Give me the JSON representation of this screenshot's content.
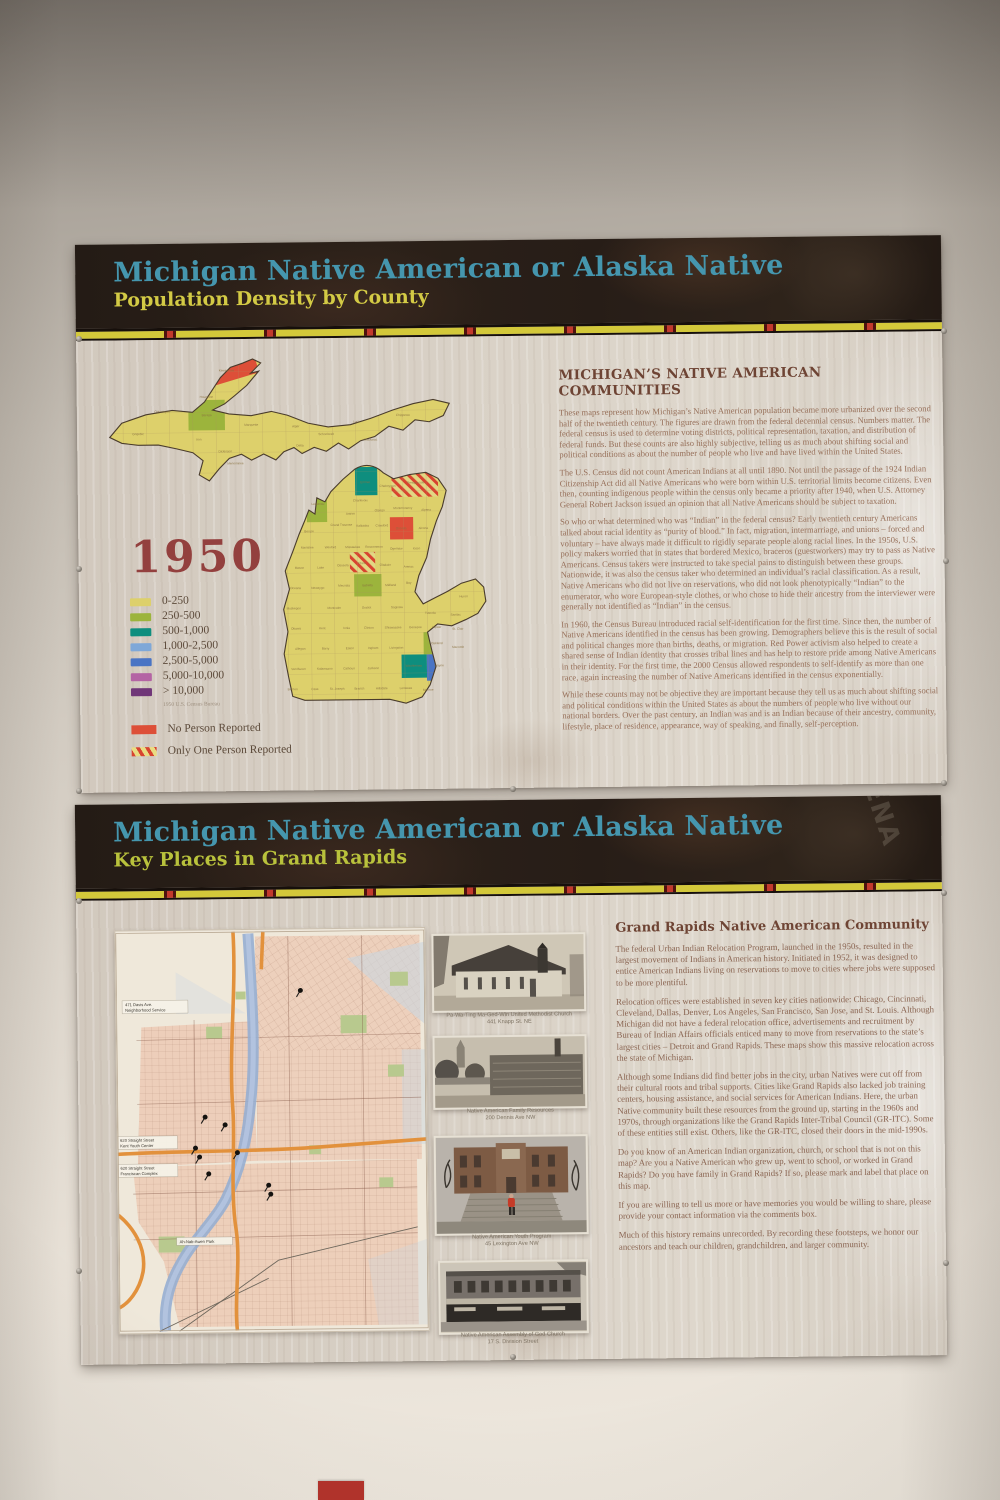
{
  "poster_population": {
    "title": "Michigan Native American or Alaska Native",
    "subtitle": "Population Density by County",
    "year": "1950",
    "source_note": "1950 U.S. Census Bureau",
    "section_heading": "MICHIGAN’S NATIVE AMERICAN COMMUNITIES",
    "paragraphs": [
      "These maps represent how Michigan’s Native American population became more urbanized over the second half of the twentieth century. The figures are drawn from the federal decennial census. Numbers matter. The federal census is used to determine voting districts, political representation, taxation, and distribution of federal funds. But these counts are also highly subjective, telling us as much about shifting social and political conditions as about the number of people who live and have lived within the United States.",
      "The U.S. Census did not count American Indians at all until 1890. Not until the passage of the 1924 Indian Citizenship Act did all Native Americans who were born within U.S. territorial limits become citizens. Even then, counting indigenous people within the census only became a priority after 1940, when U.S. Attorney General Robert Jackson issued an opinion that all Native Americans should be subject to taxation.",
      "So who or what determined who was “Indian” in the federal census? Early twentieth century Americans talked about racial identity as “purity of blood.” In fact, migration, intermarriage, and unions – forced and voluntary – have always made it difficult to rigidly separate people along racial lines. In the 1950s, U.S. policy makers worried that in states that bordered Mexico, braceros (guestworkers) may try to pass as Native Americans. Census takers were instructed to take special pains to distinguish between these groups. Nationwide, it was also the census taker who determined an individual’s racial classification. As a result, Native Americans who did not live on reservations, who did not look phenotypically “Indian” to the enumerator, who wore European-style clothes, or who chose to hide their ancestry from the interviewer were generally not identified as “Indian” in the census.",
      "In 1960, the Census Bureau introduced racial self-identification for the first time. Since then, the number of Native Americans identified in the census has been growing. Demographers believe this is the result of social and political changes more than births, deaths, or migration. Red Power activism also helped to create a shared sense of Indian identity that crosses tribal lines and has help to restore pride among Native Americans in their identity. For the first time, the 2000 Census allowed respondents to self-identify as more than one race, again increasing the number of Native Americans identified in the census exponentially.",
      "While these counts may not be objective they are important because they tell us as much about shifting social and political conditions within the United States as about the numbers of people who live without our national borders. Over the past century, an Indian was and is an Indian because of their ancestry, community, lifestyle, place of residence, appearance, way of speaking, and finally, self-perception."
    ],
    "legend": [
      {
        "label": "0-250",
        "color": "#ddd06b"
      },
      {
        "label": "250-500",
        "color": "#9cb43c"
      },
      {
        "label": "500-1,000",
        "color": "#0e8e7e"
      },
      {
        "label": "1,000-2,500",
        "color": "#7fa8d8"
      },
      {
        "label": "2,500-5,000",
        "color": "#4a74c4"
      },
      {
        "label": "5,000-10,000",
        "color": "#b464a4"
      },
      {
        "label": "> 10,000",
        "color": "#703678"
      }
    ],
    "special_legend": [
      {
        "label": "No Person Reported",
        "color": "#dd4f38",
        "pattern": "solid"
      },
      {
        "label": "Only One Person Reported",
        "color": "#d8432f",
        "pattern": "red-yellow-diagonal-stripes"
      }
    ],
    "map_highlights": [
      {
        "county": "Keweenaw",
        "status": "No Person Reported",
        "x": 96,
        "y": 4,
        "w": 60,
        "h": 26,
        "rot": "rotate(-16 126 17)",
        "fill": "#dd4f38"
      },
      {
        "county": "Baraga",
        "status": "250-500",
        "x": 88,
        "y": 48,
        "w": 36,
        "h": 30,
        "fill": "#9cb43c"
      },
      {
        "county": "Emmet",
        "status": "500-1,000",
        "x": 252,
        "y": 116,
        "w": 22,
        "h": 28,
        "fill": "#0e8e7e"
      },
      {
        "county": "Presque Isle",
        "status": "Only One Person Reported",
        "x": 288,
        "y": 120,
        "w": 46,
        "h": 26,
        "fill": "hatch"
      },
      {
        "county": "Leelanau",
        "status": "250-500",
        "x": 204,
        "y": 144,
        "w": 20,
        "h": 26,
        "fill": "#9cb43c"
      },
      {
        "county": "Oscoda",
        "status": "No Person Reported",
        "x": 286,
        "y": 166,
        "w": 23,
        "h": 22,
        "fill": "#dd4f38"
      },
      {
        "county": "Clare",
        "status": "Only One Person Reported",
        "x": 246,
        "y": 200,
        "w": 25,
        "h": 20,
        "fill": "hatch"
      },
      {
        "county": "Isabella",
        "status": "250-500",
        "x": 250,
        "y": 222,
        "w": 27,
        "h": 22,
        "fill": "#9cb43c"
      },
      {
        "county": "Oakland",
        "status": "250-500",
        "x": 318,
        "y": 280,
        "w": 27,
        "h": 22,
        "fill": "#9cb43c"
      },
      {
        "county": "Washtenaw",
        "status": "500-1,000",
        "x": 296,
        "y": 302,
        "w": 25,
        "h": 23,
        "fill": "#0e8e7e"
      },
      {
        "county": "Wayne",
        "status": "2,500-5,000",
        "x": 321,
        "y": 302,
        "w": 27,
        "h": 26,
        "fill": "#4a74c4"
      }
    ],
    "map_counties": [
      {
        "n": "Gogebic",
        "x": 38,
        "y": 82
      },
      {
        "n": "Ontonagon",
        "x": 62,
        "y": 60
      },
      {
        "n": "Houghton",
        "x": 106,
        "y": 46
      },
      {
        "n": "Keweenaw",
        "x": 126,
        "y": 20
      },
      {
        "n": "Baraga",
        "x": 106,
        "y": 64
      },
      {
        "n": "Iron",
        "x": 98,
        "y": 88
      },
      {
        "n": "Marquette",
        "x": 150,
        "y": 74
      },
      {
        "n": "Dickinson",
        "x": 124,
        "y": 100
      },
      {
        "n": "Menominee",
        "x": 134,
        "y": 112
      },
      {
        "n": "Delta",
        "x": 198,
        "y": 95
      },
      {
        "n": "Alger",
        "x": 194,
        "y": 76
      },
      {
        "n": "Schoolcraft",
        "x": 224,
        "y": 84
      },
      {
        "n": "Luce",
        "x": 254,
        "y": 72
      },
      {
        "n": "Mackinac",
        "x": 268,
        "y": 90
      },
      {
        "n": "Chippewa",
        "x": 300,
        "y": 66
      },
      {
        "n": "Emmet",
        "x": 262,
        "y": 132
      },
      {
        "n": "Cheboygan",
        "x": 284,
        "y": 136
      },
      {
        "n": "Presque Isle",
        "x": 312,
        "y": 133
      },
      {
        "n": "Charlevoix",
        "x": 257,
        "y": 150
      },
      {
        "n": "Antrim",
        "x": 247,
        "y": 163
      },
      {
        "n": "Otsego",
        "x": 276,
        "y": 160
      },
      {
        "n": "Montmorency",
        "x": 299,
        "y": 158
      },
      {
        "n": "Alpena",
        "x": 322,
        "y": 160
      },
      {
        "n": "Leelanau",
        "x": 215,
        "y": 153
      },
      {
        "n": "Grand Traverse",
        "x": 238,
        "y": 174
      },
      {
        "n": "Kalkaska",
        "x": 259,
        "y": 175
      },
      {
        "n": "Crawford",
        "x": 278,
        "y": 175
      },
      {
        "n": "Oscoda",
        "x": 297,
        "y": 178
      },
      {
        "n": "Alcona",
        "x": 319,
        "y": 178
      },
      {
        "n": "Benzie",
        "x": 206,
        "y": 180
      },
      {
        "n": "Manistee",
        "x": 204,
        "y": 196
      },
      {
        "n": "Wexford",
        "x": 227,
        "y": 196
      },
      {
        "n": "Missaukee",
        "x": 249,
        "y": 196
      },
      {
        "n": "Roscommon",
        "x": 270,
        "y": 196
      },
      {
        "n": "Ogemaw",
        "x": 292,
        "y": 198
      },
      {
        "n": "Iosco",
        "x": 312,
        "y": 198
      },
      {
        "n": "Mason",
        "x": 196,
        "y": 216
      },
      {
        "n": "Lake",
        "x": 217,
        "y": 216
      },
      {
        "n": "Osceola",
        "x": 239,
        "y": 214
      },
      {
        "n": "Clare",
        "x": 258,
        "y": 212
      },
      {
        "n": "Gladwin",
        "x": 281,
        "y": 214
      },
      {
        "n": "Arenac",
        "x": 304,
        "y": 216
      },
      {
        "n": "Oceana",
        "x": 192,
        "y": 236
      },
      {
        "n": "Newaygo",
        "x": 214,
        "y": 236
      },
      {
        "n": "Mecosta",
        "x": 240,
        "y": 234
      },
      {
        "n": "Isabella",
        "x": 263,
        "y": 234
      },
      {
        "n": "Midland",
        "x": 286,
        "y": 234
      },
      {
        "n": "Bay",
        "x": 304,
        "y": 232
      },
      {
        "n": "Huron",
        "x": 358,
        "y": 246
      },
      {
        "n": "Muskegon",
        "x": 190,
        "y": 256
      },
      {
        "n": "Montcalm",
        "x": 230,
        "y": 256
      },
      {
        "n": "Gratiot",
        "x": 262,
        "y": 256
      },
      {
        "n": "Saginaw",
        "x": 292,
        "y": 256
      },
      {
        "n": "Tuscola",
        "x": 325,
        "y": 262
      },
      {
        "n": "Sanilac",
        "x": 350,
        "y": 264
      },
      {
        "n": "Ottawa",
        "x": 192,
        "y": 276
      },
      {
        "n": "Kent",
        "x": 218,
        "y": 276
      },
      {
        "n": "Ionia",
        "x": 242,
        "y": 276
      },
      {
        "n": "Clinton",
        "x": 264,
        "y": 276
      },
      {
        "n": "Shiawassee",
        "x": 288,
        "y": 276
      },
      {
        "n": "Genesee",
        "x": 310,
        "y": 276
      },
      {
        "n": "Lapeer",
        "x": 331,
        "y": 276
      },
      {
        "n": "St. Clair",
        "x": 352,
        "y": 278
      },
      {
        "n": "Allegan",
        "x": 196,
        "y": 296
      },
      {
        "n": "Barry",
        "x": 221,
        "y": 296
      },
      {
        "n": "Eaton",
        "x": 245,
        "y": 296
      },
      {
        "n": "Ingham",
        "x": 268,
        "y": 296
      },
      {
        "n": "Livingston",
        "x": 291,
        "y": 296
      },
      {
        "n": "Oakland",
        "x": 331,
        "y": 292
      },
      {
        "n": "Macomb",
        "x": 352,
        "y": 296
      },
      {
        "n": "Van Buren",
        "x": 194,
        "y": 316
      },
      {
        "n": "Kalamazoo",
        "x": 220,
        "y": 316
      },
      {
        "n": "Calhoun",
        "x": 244,
        "y": 316
      },
      {
        "n": "Jackson",
        "x": 268,
        "y": 316
      },
      {
        "n": "Washtenaw",
        "x": 308,
        "y": 314
      },
      {
        "n": "Wayne",
        "x": 333,
        "y": 314
      },
      {
        "n": "Berrien",
        "x": 188,
        "y": 336
      },
      {
        "n": "Cass",
        "x": 210,
        "y": 336
      },
      {
        "n": "St. Joseph",
        "x": 232,
        "y": 336
      },
      {
        "n": "Branch",
        "x": 254,
        "y": 336
      },
      {
        "n": "Hillsdale",
        "x": 276,
        "y": 336
      },
      {
        "n": "Lenawee",
        "x": 300,
        "y": 336
      },
      {
        "n": "Monroe",
        "x": 322,
        "y": 338
      }
    ]
  },
  "poster_places": {
    "title": "Michigan Native American or Alaska Native",
    "subtitle": "Key Places in Grand Rapids",
    "section_heading": "Grand Rapids Native American Community",
    "banner_overlay_text": "ENA",
    "paragraphs": [
      "The federal Urban Indian Relocation Program, launched in the 1950s, resulted in the largest movement of Indians in American history. Initiated in 1952, it was designed to entice American Indians living on reservations to move to cities where jobs were supposed to be more plentiful.",
      "Relocation offices were established in seven key cities nationwide: Chicago, Cincinnati, Cleveland, Dallas, Denver, Los Angeles, San Francisco, San Jose, and St. Louis. Although Michigan did not have a federal relocation office, advertisements and recruitment by Bureau of Indian Affairs officials enticed many to move from reservations to the state’s largest cities – Detroit and Grand Rapids. These maps show this massive relocation across the state of Michigan.",
      "Although some Indians did find better jobs in the city, urban Natives were cut off from their cultural roots and tribal supports. Cities like Grand Rapids also lacked job training centers, housing assistance, and social services for American Indians. Here, the urban Native community built these resources from the ground up, starting in the 1960s and 1970s, through organizations like the Grand Rapids Inter-Tribal Council (GR-ITC). Some of these entities still exist. Others, like the GR-ITC, closed their doors in the mid-1990s.",
      "Do you know of an American Indian organization, church, or school that is not on this map? Are you a Native American who grew up, went to school, or worked in Grand Rapids? Do you have family in Grand Rapids? If so, please mark and label that place on this map.",
      "If you are willing to tell us more or have memories you would be willing to share, please provide your contact information via the comments box.",
      "Much of this history remains unrecorded. By recording these footsteps, we honor our ancestors and teach our children, grandchildren, and larger community."
    ],
    "map_labels": [
      {
        "line1": "471 Davis Ave.",
        "line2": "Neighborhood Service"
      },
      {
        "line1": "620 Straight Street",
        "line2": "Kent Youth Center"
      },
      {
        "line1": "620 Straight Street",
        "line2": "Franciscan Complex"
      },
      {
        "line1": "Ah-Nab-Awen Park",
        "line2": ""
      }
    ],
    "map_pins": [
      {
        "x": 181,
        "y": 66
      },
      {
        "x": 84,
        "y": 192
      },
      {
        "x": 104,
        "y": 200
      },
      {
        "x": 74,
        "y": 223
      },
      {
        "x": 78,
        "y": 232
      },
      {
        "x": 116,
        "y": 228
      },
      {
        "x": 87,
        "y": 249
      },
      {
        "x": 147,
        "y": 261
      },
      {
        "x": 149,
        "y": 270
      }
    ],
    "photo_captions": [
      {
        "text": "Pa-Wa-Ting Ma-Ged-Win United Methodist Church\n441 Knapp St. NE"
      },
      {
        "text": "Native American Family Resources\n200 Dennis Ave NW"
      },
      {
        "text": "Native American Youth Program\n45 Lexington Ave NW"
      },
      {
        "text": "Native American Assembly of God Church\n17 S. Division Street"
      }
    ]
  },
  "colors": {
    "banner_background": "#241b15",
    "title_teal": "#4596ae",
    "subtitle_yellow": "#d3ca45",
    "subtitle_green": "#b9c23c",
    "year_maroon": "#93403e",
    "strip_yellow": "#d3c83a",
    "strip_red": "#c23a2c",
    "wall_artifact_red": "#b5342c"
  }
}
